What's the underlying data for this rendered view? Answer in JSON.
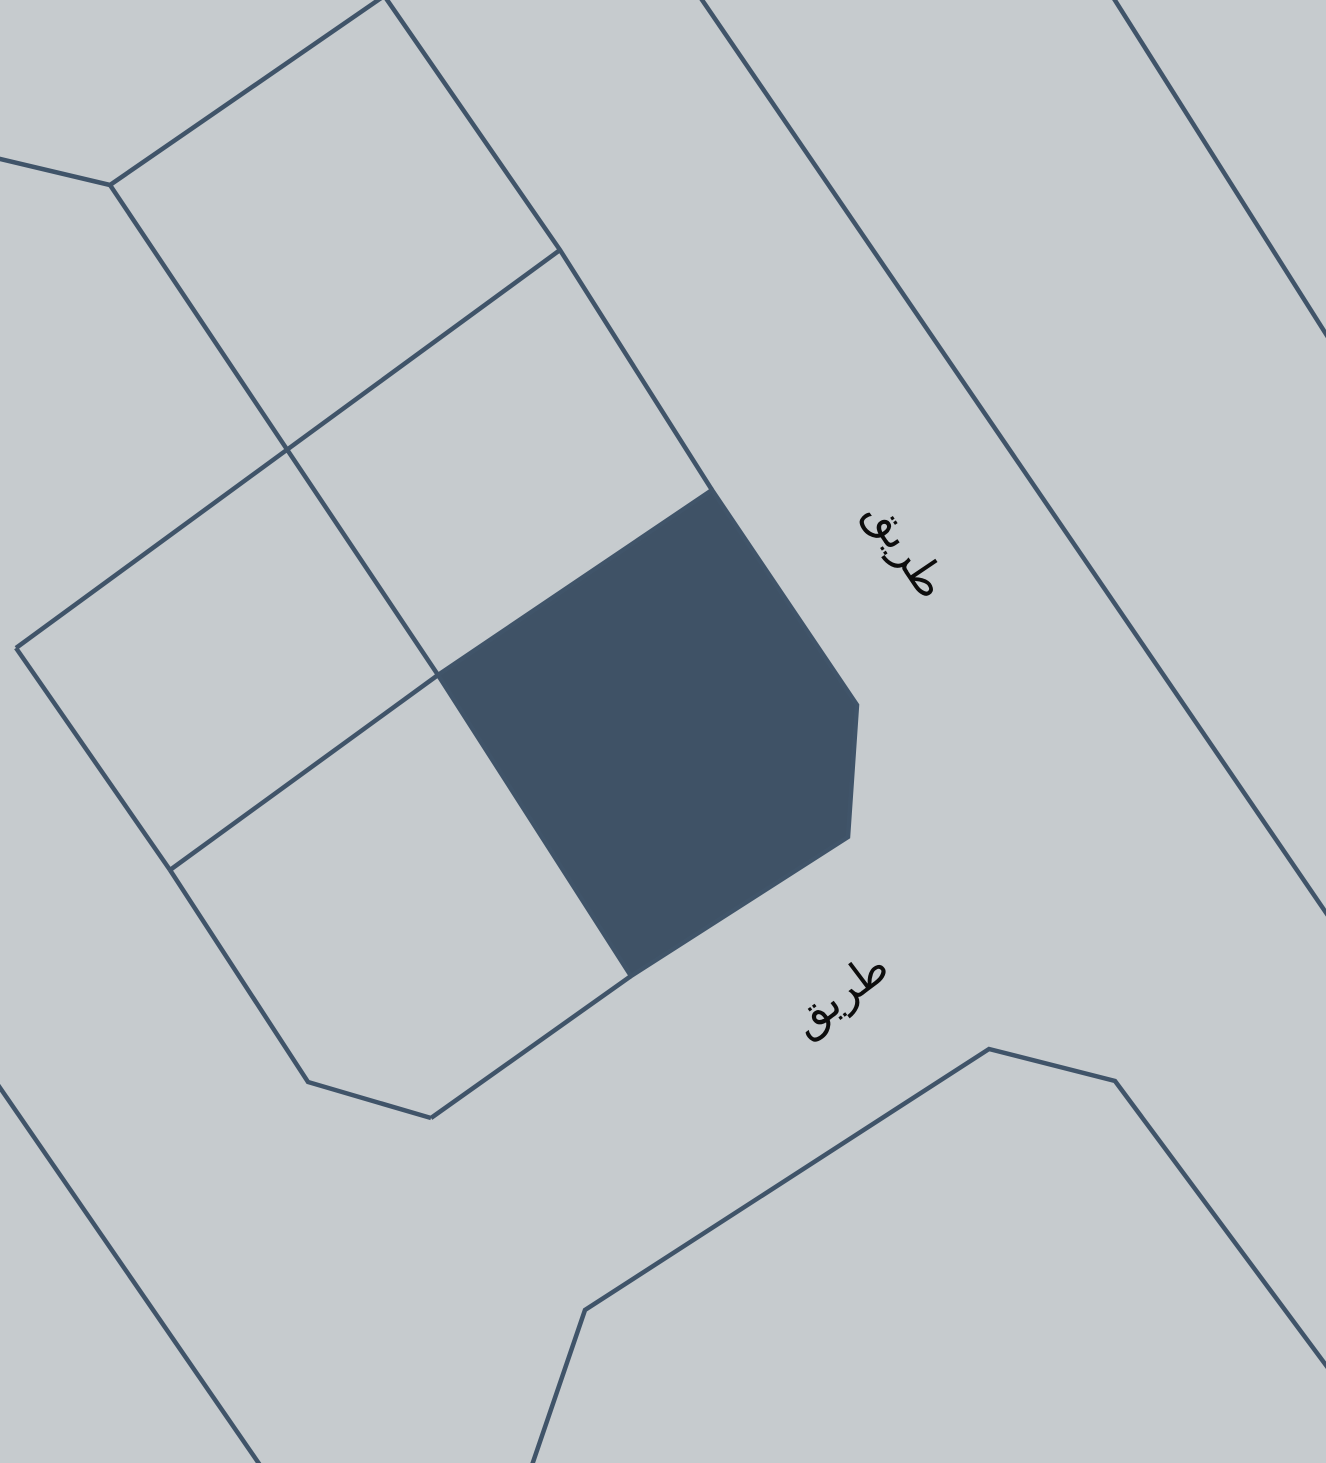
{
  "map": {
    "canvas": {
      "width": 1326,
      "height": 1463
    },
    "colors": {
      "background": "#c6cbce",
      "boundary_line": "#405469",
      "highlight_parcel_fill": "#3f5266",
      "label_text": "#0d0d0d"
    },
    "line_width": 4.5,
    "boundaries": [
      {
        "name": "left-edge-stub",
        "points": [
          [
            -4,
            158
          ],
          [
            110,
            185
          ]
        ]
      },
      {
        "name": "block-nw-edge",
        "points": [
          [
            110,
            185
          ],
          [
            387,
            -6
          ]
        ]
      },
      {
        "name": "block-column-divider",
        "points": [
          [
            110,
            185
          ],
          [
            438,
            675
          ]
        ]
      },
      {
        "name": "block-row-divider",
        "points": [
          [
            560,
            250
          ],
          [
            16,
            648
          ]
        ]
      },
      {
        "name": "block-ne-edge",
        "points": [
          [
            383,
            -6
          ],
          [
            560,
            250
          ],
          [
            712,
            490
          ]
        ]
      },
      {
        "name": "block-w-edge",
        "points": [
          [
            16,
            648
          ],
          [
            170,
            870
          ]
        ]
      },
      {
        "name": "block-sw-edge",
        "points": [
          [
            170,
            870
          ],
          [
            308,
            1082
          ],
          [
            431,
            1118
          ]
        ]
      },
      {
        "name": "block-lower-divider",
        "points": [
          [
            438,
            675
          ],
          [
            170,
            870
          ]
        ]
      },
      {
        "name": "block-s-road-edge",
        "points": [
          [
            431,
            1118
          ],
          [
            631,
            976
          ]
        ]
      },
      {
        "name": "road-east-edge",
        "points": [
          [
            698,
            -6
          ],
          [
            1331,
            920
          ]
        ]
      },
      {
        "name": "road-far-east-edge",
        "points": [
          [
            1111,
            -6
          ],
          [
            1331,
            342
          ]
        ]
      },
      {
        "name": "southwest-road-edge",
        "points": [
          [
            -4,
            1082
          ],
          [
            262,
            1468
          ]
        ]
      },
      {
        "name": "southeast-parcel-outline",
        "points": [
          [
            531,
            1468
          ],
          [
            585,
            1310
          ],
          [
            989,
            1049
          ],
          [
            1115,
            1081
          ],
          [
            1331,
            1372
          ]
        ]
      }
    ],
    "highlighted_parcel": {
      "name": "highlighted-parcel",
      "points": [
        [
          712,
          490
        ],
        [
          857,
          705
        ],
        [
          848,
          837
        ],
        [
          631,
          976
        ],
        [
          438,
          675
        ]
      ]
    },
    "labels": [
      {
        "text": "طريق",
        "x": 906,
        "y": 549,
        "rotation": 56,
        "font_size": 44
      },
      {
        "text": "طريق",
        "x": 840,
        "y": 994,
        "rotation": -37,
        "font_size": 44
      }
    ]
  }
}
